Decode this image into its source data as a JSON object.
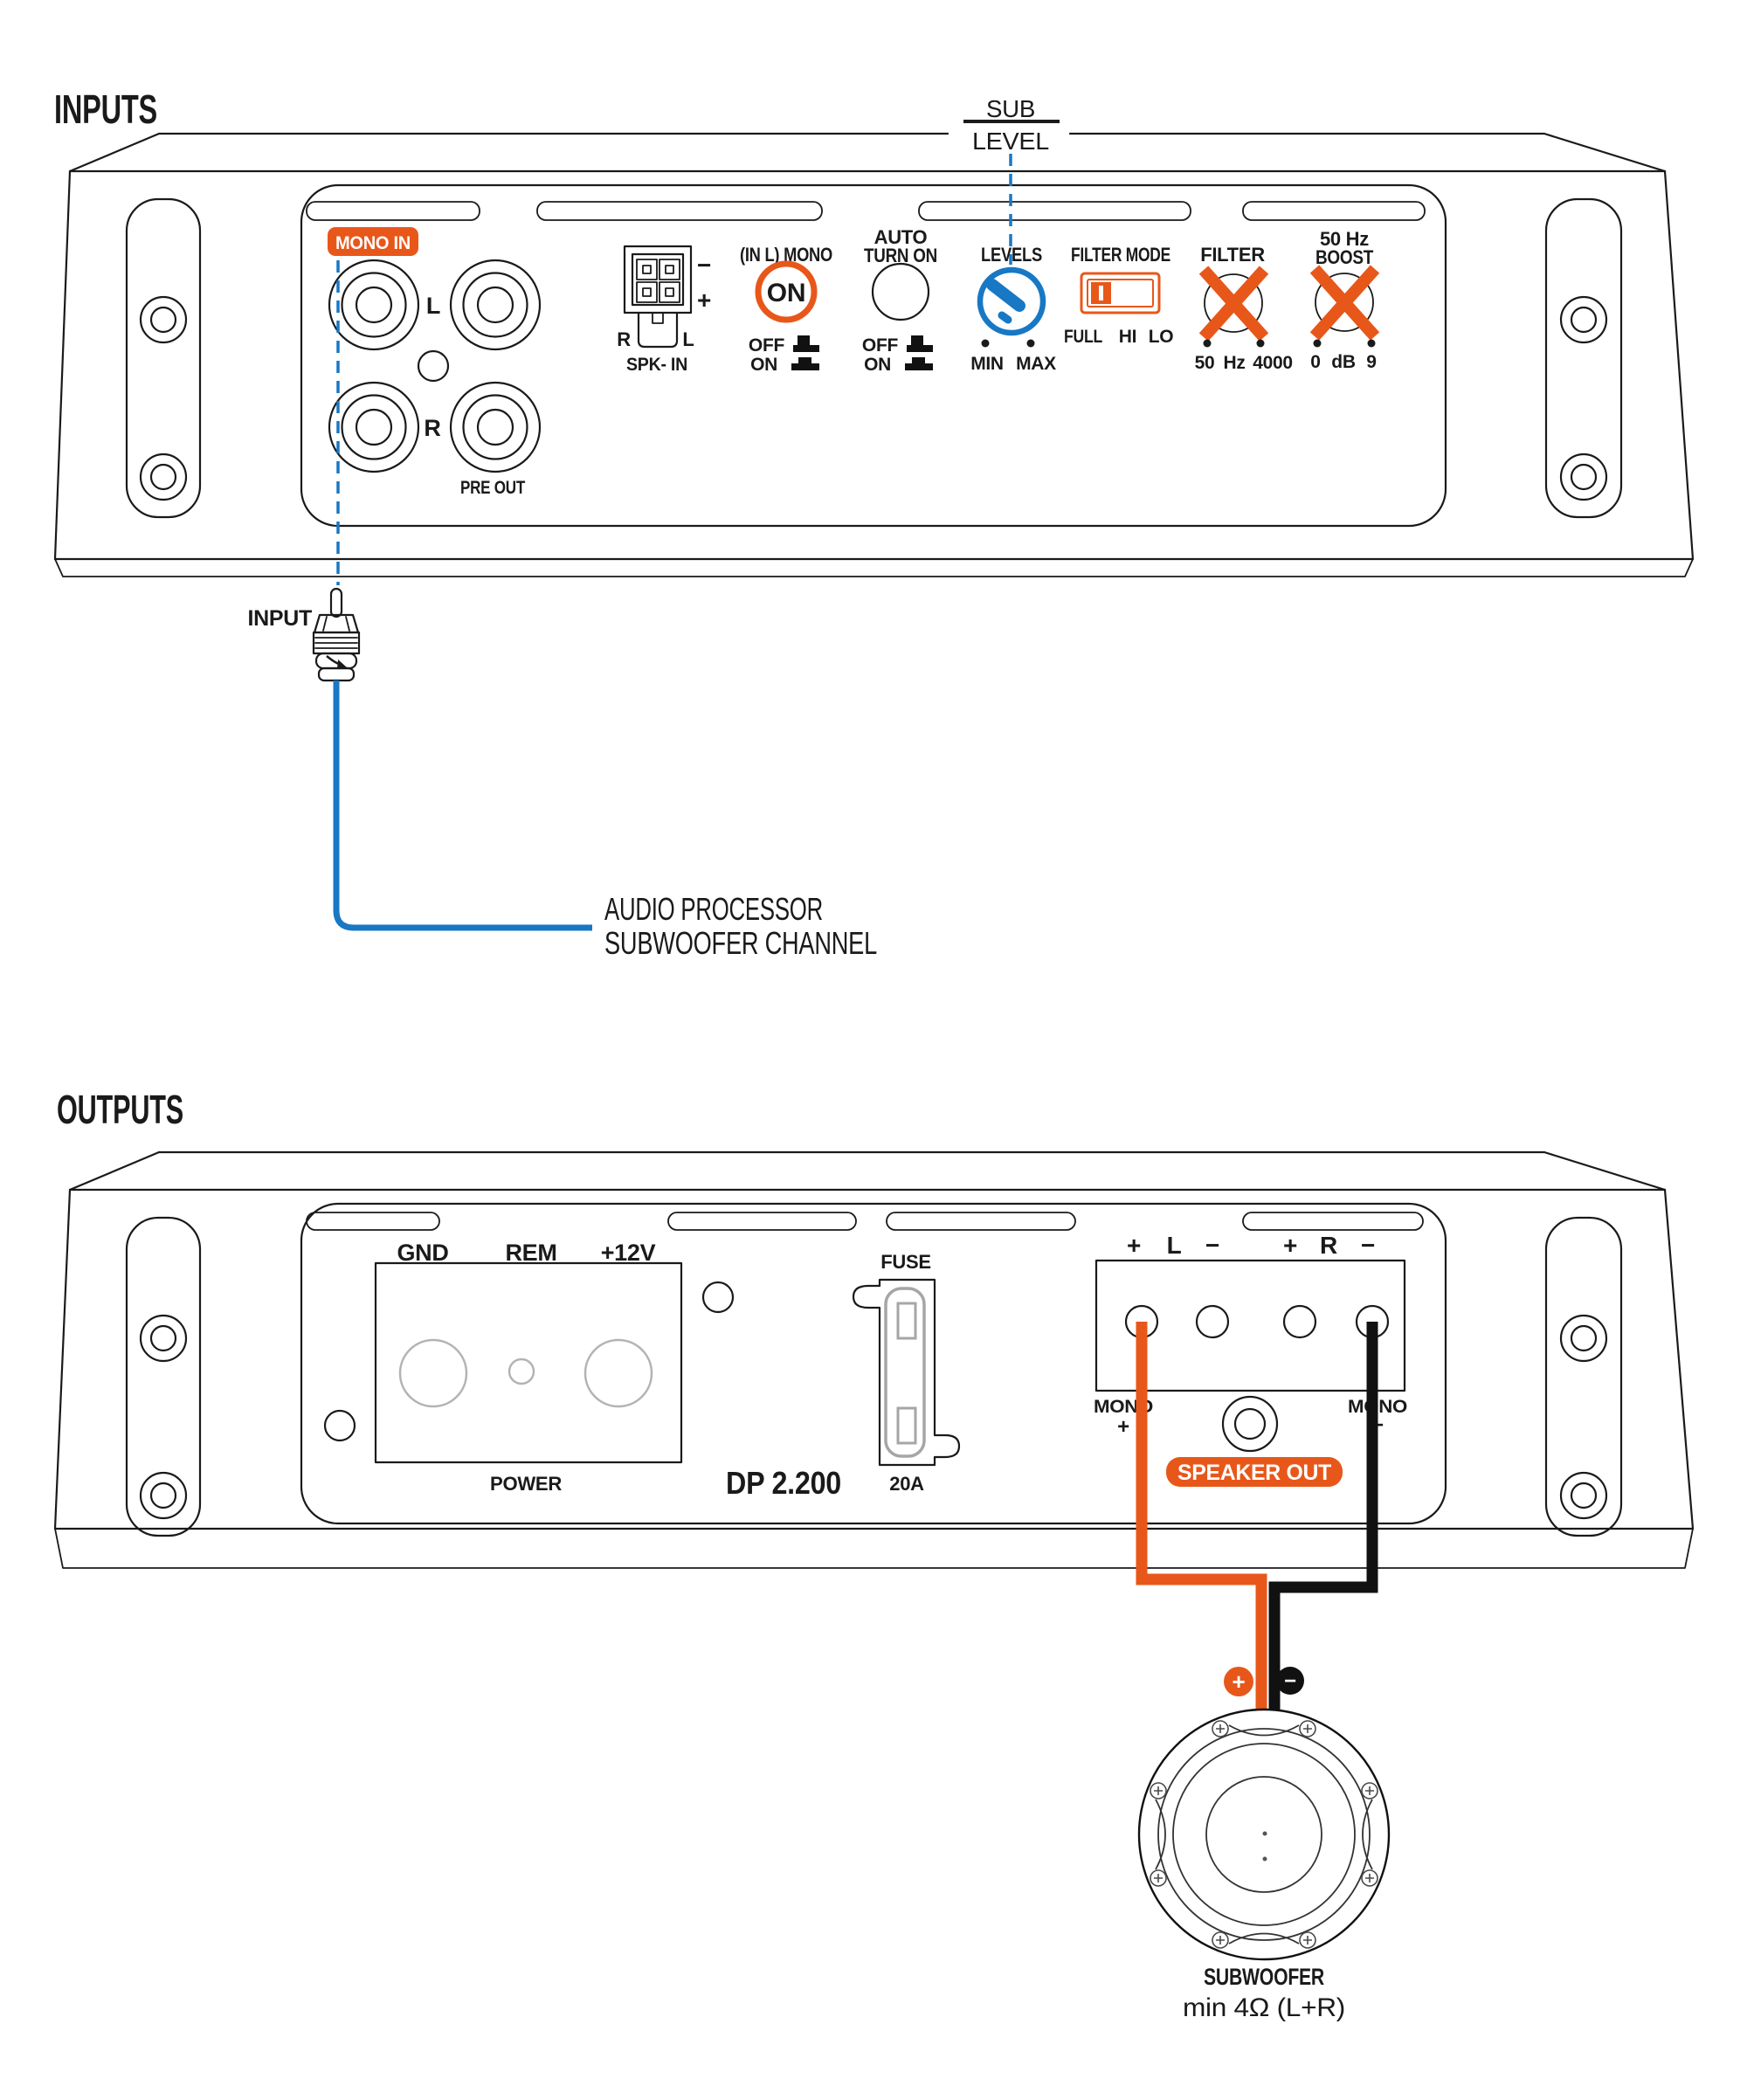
{
  "colors": {
    "orange": "#E8571A",
    "blue": "#1878C4",
    "ink": "#1a1a1a",
    "wire_black": "#111111"
  },
  "inputs": {
    "title": "INPUTS",
    "sub_level": {
      "top": "SUB",
      "bottom": "LEVEL"
    },
    "panel": {
      "mono_in": "MONO IN",
      "rca_left": "L",
      "rca_right": "R",
      "pre_out": "PRE OUT",
      "spk_in": {
        "minus": "−",
        "plus": "+",
        "r": "R",
        "l": "L",
        "label": "SPK- IN"
      },
      "mono_switch": {
        "title": "(IN L) MONO",
        "state": "ON",
        "off": "OFF",
        "on": "ON"
      },
      "auto_turn_on": {
        "title1": "AUTO",
        "title2": "TURN ON",
        "off": "OFF",
        "on": "ON"
      },
      "levels": {
        "title": "LEVELS",
        "min": "MIN",
        "max": "MAX"
      },
      "filter_mode": {
        "title": "FILTER MODE",
        "full": "FULL",
        "hi": "HI",
        "lo": "LO"
      },
      "filter": {
        "title": "FILTER",
        "lo": "50",
        "unit": "Hz",
        "hi": "4000"
      },
      "boost": {
        "title1": "50 Hz",
        "title2": "BOOST",
        "lo": "0",
        "unit": "dB",
        "hi": "9"
      }
    },
    "input_label": "INPUT",
    "note1": "AUDIO PROCESSOR",
    "note2": "SUBWOOFER CHANNEL"
  },
  "outputs": {
    "title": "OUTPUTS",
    "power": {
      "gnd": "GND",
      "rem": "REM",
      "plus12v": "+12V",
      "label": "POWER"
    },
    "model": "DP 2.200",
    "fuse": {
      "label": "FUSE",
      "rating": "20A"
    },
    "speaker_out": {
      "l_plus": "+",
      "l": "L",
      "l_minus": "−",
      "r_plus": "+",
      "r": "R",
      "r_minus": "−",
      "mono_plus_word": "MONO",
      "mono_plus_sign": "+",
      "mono_minus_word": "MONO",
      "mono_minus_sign": "−",
      "badge": "SPEAKER OUT"
    },
    "wire": {
      "plus": "+",
      "minus": "−"
    },
    "subwoofer": {
      "name": "SUBWOOFER",
      "spec": "min 4Ω (L+R)"
    }
  }
}
